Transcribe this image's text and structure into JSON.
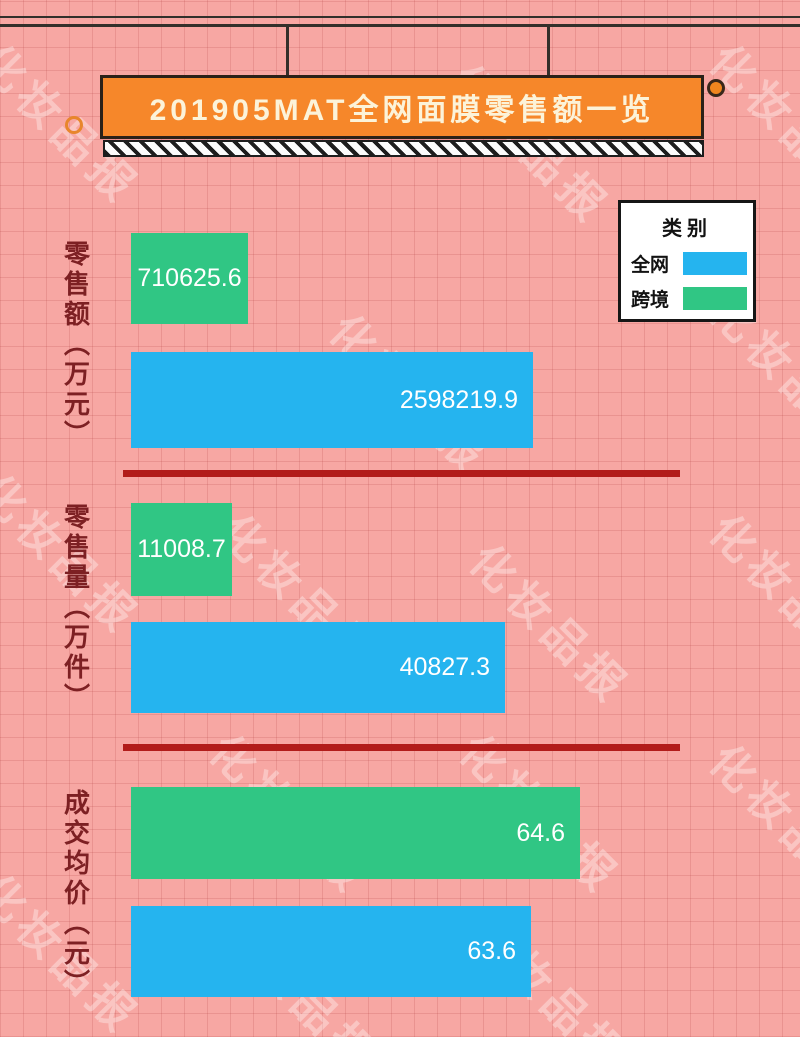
{
  "header": {
    "title": "201905MAT全网面膜零售额一览",
    "banner_color": "#f6872a",
    "banner_text_color": "#fcf3d9"
  },
  "legend": {
    "title": "类别",
    "items": [
      {
        "label": "全网",
        "color": "#25b4ef"
      },
      {
        "label": "跨境",
        "color": "#30c684"
      }
    ]
  },
  "watermark": {
    "text": "化妆品报"
  },
  "page_colors": {
    "background": "#f7a7a3",
    "grid_line": "#d98a87",
    "divider_red": "#b21c1a",
    "axis_label_maroon": "#7d2023"
  },
  "chart_data": {
    "type": "bar",
    "orientation": "horizontal",
    "title": "201905MAT全网面膜零售额一览",
    "legend_position": "top-right",
    "grid": true,
    "series_names": [
      "跨境",
      "全网"
    ],
    "groups": [
      {
        "category": "零售额（万元）",
        "series": [
          {
            "name": "跨境",
            "value": 710625.6,
            "label": "710625.6",
            "color": "#30c684",
            "bar_px": 117
          },
          {
            "name": "全网",
            "value": 2598219.9,
            "label": "2598219.9",
            "color": "#25b4ef",
            "bar_px": 402
          }
        ]
      },
      {
        "category": "零售量（万件）",
        "series": [
          {
            "name": "跨境",
            "value": 11008.7,
            "label": "11008.7",
            "color": "#30c684",
            "bar_px": 101
          },
          {
            "name": "全网",
            "value": 40827.3,
            "label": "40827.3",
            "color": "#25b4ef",
            "bar_px": 374
          }
        ]
      },
      {
        "category": "成交均价（元）",
        "series": [
          {
            "name": "跨境",
            "value": 64.6,
            "label": "64.6",
            "color": "#30c684",
            "bar_px": 449
          },
          {
            "name": "全网",
            "value": 63.6,
            "label": "63.6",
            "color": "#25b4ef",
            "bar_px": 400
          }
        ]
      }
    ]
  }
}
